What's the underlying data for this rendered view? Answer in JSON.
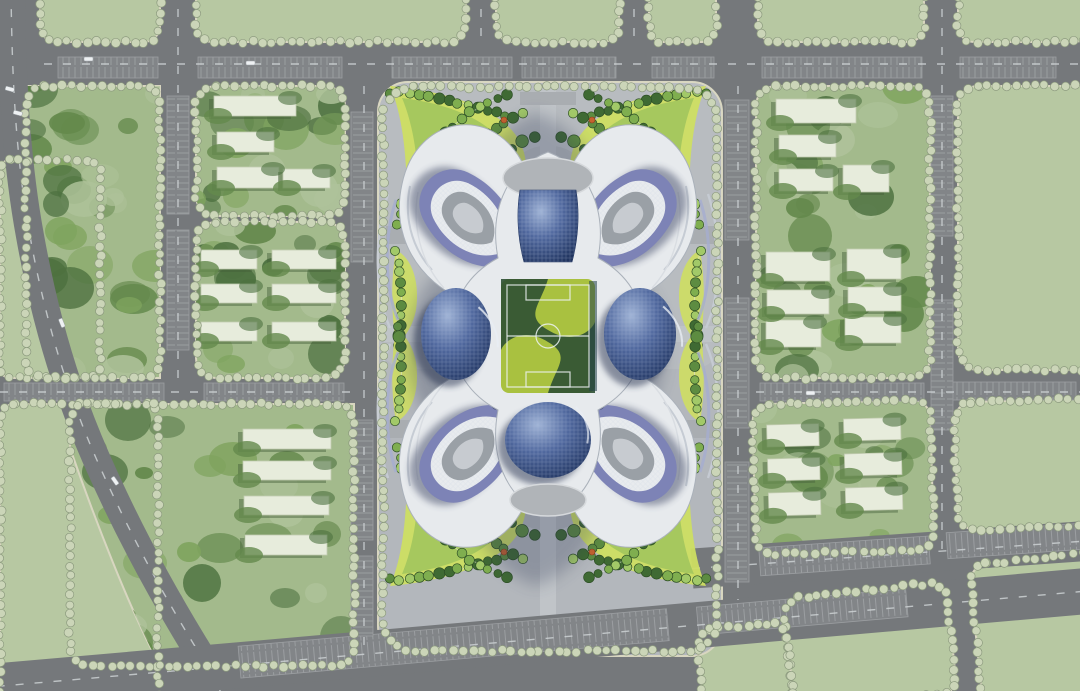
{
  "meta": {
    "kind": "architectural-master-plan-rendering",
    "visible_text": "none"
  },
  "palette": {
    "road": "#75787b",
    "hatch_fill": "#828588",
    "hatch_line": "#9b9ea1",
    "lane": "#cdd1d4",
    "field_green": "#b7c8a2",
    "block_green": "#a3ba8c",
    "curb": "#d8d6c0",
    "tree_mass_dark": "#4d7140",
    "tree_mass_mid": "#64894c",
    "tree_mass_light": "#7fa45e",
    "ground_light": "#aec29a",
    "street_tree": "#cbd5b8",
    "street_tree_rim": "#8c9a7e",
    "slab_white": "#e7ecdc",
    "slab_shadow": "#44603a",
    "plot_gray": "#b3b7bc",
    "plot_light": "#c0c4c8",
    "pad_gray": "#a9adb1",
    "building_white": "#e7eaed",
    "building_silver": "#c6ccd4",
    "ring_purple": "#7d83b6",
    "ring_purple_light": "#a5acd0",
    "ring_navy": "#323c64",
    "dome_light": "#9fb3d6",
    "dome_mid": "#51699f",
    "dome_dark": "#20345f",
    "court_gray": "#9aa0a6",
    "court_light": "#c7cbd0",
    "lawn_bright": "#a9c140",
    "lawn_dark": "#2d5033",
    "ribbon_yellow": "#cede62",
    "ribbon_green": "#9cc35c",
    "tree_a": "#3f6a33",
    "tree_b": "#5d8c41",
    "tree_c": "#7fae4f",
    "tree_d": "#a2c968",
    "shrub_orange": "#c4622f",
    "shadow_navy": "#2b3452",
    "car_white": "#eef1f3"
  },
  "map": {
    "canvas": {
      "w": 1080,
      "h": 691
    },
    "fields": [
      {
        "id": "f12a",
        "x": 0,
        "y": 160,
        "w": 100,
        "h": 218,
        "r": 10
      },
      {
        "id": "f12b",
        "x": 0,
        "y": 404,
        "w": 158,
        "h": 306,
        "r": 14
      },
      {
        "id": "f1",
        "x": 40,
        "y": -24,
        "w": 120,
        "h": 66,
        "r": 16
      },
      {
        "id": "f2",
        "x": 196,
        "y": -24,
        "w": 270,
        "h": 66,
        "r": 16
      },
      {
        "id": "f3",
        "x": 496,
        "y": -24,
        "w": 123,
        "h": 66,
        "r": 16
      },
      {
        "id": "f4",
        "x": 649,
        "y": -24,
        "w": 67,
        "h": 66,
        "r": 14
      },
      {
        "id": "f5",
        "x": 758,
        "y": -24,
        "w": 166,
        "h": 66,
        "r": 16
      },
      {
        "id": "f6",
        "x": 958,
        "y": -24,
        "w": 132,
        "h": 66,
        "r": 16
      },
      {
        "id": "f7",
        "x": 958,
        "y": 86,
        "w": 150,
        "h": 284,
        "r": 20
      },
      {
        "id": "f8",
        "x": 956,
        "y": 400,
        "w": 152,
        "h": 128,
        "r": 18,
        "rot": -2
      },
      {
        "id": "f9",
        "x": 976,
        "y": 558,
        "w": 140,
        "h": 150,
        "r": 18,
        "rot": -6
      },
      {
        "id": "f10",
        "x": 788,
        "y": 590,
        "w": 164,
        "h": 112,
        "r": 16,
        "rot": -6
      },
      {
        "id": "f11",
        "x": 700,
        "y": 626,
        "w": 90,
        "h": 84,
        "r": 14,
        "rot": -6
      }
    ],
    "tree_blocks": [
      {
        "id": "tb1",
        "poly": "M26,86 L160,86 L160,378 L62,378 L42,300 L30,206 L24,130 Z",
        "ring": [
          26,
          86,
          134,
          292,
          18
        ],
        "n": 34,
        "seed": 11
      },
      {
        "id": "b2",
        "rect": [
          196,
          86,
          149,
          130,
          20
        ],
        "n": 20,
        "seed": 22
      },
      {
        "id": "b3",
        "rect": [
          196,
          222,
          149,
          156,
          20
        ],
        "n": 22,
        "seed": 33
      },
      {
        "id": "b4",
        "rect": [
          756,
          86,
          174,
          292,
          20
        ],
        "n": 34,
        "seed": 44
      },
      {
        "id": "b5",
        "rect": [
          754,
          402,
          178,
          150,
          18
        ],
        "rot": [
          -1.5,
          843,
          477
        ],
        "n": 20,
        "seed": 55
      },
      {
        "id": "bl",
        "poly": "M70,404 L354,404 L354,666 L160,666 C130,610 95,520 70,448 Z",
        "ring": [
          70,
          404,
          284,
          262,
          18
        ],
        "n": 30,
        "seed": 66
      }
    ],
    "slabs": {
      "b2": [
        [
          214,
          96,
          82,
          20
        ],
        [
          217,
          132,
          57,
          20
        ],
        [
          217,
          167,
          62,
          21
        ],
        [
          283,
          169,
          47,
          19
        ]
      ],
      "b3": [
        [
          201,
          250,
          56,
          19
        ],
        [
          272,
          250,
          64,
          19
        ],
        [
          201,
          284,
          56,
          19
        ],
        [
          272,
          284,
          64,
          19
        ],
        [
          201,
          322,
          56,
          19
        ],
        [
          272,
          322,
          64,
          19
        ]
      ],
      "b4": [
        [
          776,
          99,
          80,
          24
        ],
        [
          779,
          135,
          57,
          22
        ],
        [
          779,
          169,
          54,
          22
        ],
        [
          843,
          165,
          46,
          27
        ],
        [
          766,
          252,
          64,
          29
        ],
        [
          847,
          249,
          54,
          30
        ],
        [
          767,
          290,
          62,
          24
        ],
        [
          848,
          287,
          53,
          24
        ],
        [
          766,
          320,
          55,
          27
        ],
        [
          845,
          317,
          56,
          26
        ]
      ],
      "b5": [
        [
          768,
          423,
          52,
          22
        ],
        [
          845,
          419,
          57,
          22
        ],
        [
          768,
          457,
          52,
          22
        ],
        [
          845,
          454,
          57,
          22
        ],
        [
          768,
          491,
          52,
          23
        ],
        [
          845,
          488,
          57,
          23
        ]
      ],
      "bl": [
        [
          243,
          429,
          88,
          20
        ],
        [
          243,
          461,
          88,
          19
        ],
        [
          244,
          496,
          85,
          19
        ],
        [
          245,
          535,
          82,
          20
        ]
      ]
    },
    "plot": {
      "x": 378,
      "y": 82,
      "w": 344,
      "h": 574,
      "r": 30,
      "walk_v": [
        540,
        88,
        16,
        556
      ],
      "walk_h": [
        384,
        326,
        332,
        16
      ],
      "circles": [
        [
          548,
          192,
          50
        ],
        [
          548,
          478,
          56
        ]
      ],
      "pads": [
        [
          684,
          226,
          30,
          18
        ],
        [
          684,
          420,
          30,
          18
        ],
        [
          386,
          226,
          30,
          18
        ],
        [
          386,
          420,
          30,
          18
        ],
        [
          520,
          92,
          56,
          13
        ],
        [
          520,
          638,
          56,
          11
        ]
      ]
    },
    "roads": {
      "diagonal": "M11,-10 C12,80 16,160 30,236 C44,314 66,390 96,458 C124,522 158,586 196,648 C208,668 216,680 224,700",
      "diagonal_width": 28,
      "bottom": {
        "rot": [
          -5,
          150,
          672
        ],
        "rect": [
          -80,
          650,
          1300,
          46
        ],
        "hatch": [
          [
            240,
            654,
            430,
            32
          ],
          [
            700,
            655,
            210,
            28
          ]
        ],
        "lane_y": 673
      },
      "right_low": {
        "rot": [
          -4,
          700,
          568
        ],
        "rect": [
          692,
          548,
          480,
          40
        ],
        "hatch": [
          [
            760,
            552,
            170,
            28
          ],
          [
            948,
            550,
            150,
            26
          ]
        ],
        "lane_y": 568
      },
      "hatches_h": [
        [
          58,
          57,
          100,
          21
        ],
        [
          198,
          57,
          144,
          21
        ],
        [
          392,
          57,
          120,
          21
        ],
        [
          522,
          57,
          94,
          21
        ],
        [
          652,
          57,
          62,
          21
        ],
        [
          762,
          57,
          160,
          21
        ],
        [
          960,
          57,
          96,
          21
        ],
        [
          4,
          383,
          160,
          18
        ],
        [
          204,
          383,
          140,
          18
        ],
        [
          760,
          383,
          164,
          18
        ],
        [
          936,
          382,
          140,
          18
        ]
      ],
      "hatches_v": [
        [
          167,
          96,
          22,
          118
        ],
        [
          167,
          230,
          22,
          120
        ],
        [
          351,
          112,
          22,
          150
        ],
        [
          351,
          420,
          22,
          120
        ],
        [
          351,
          556,
          22,
          80
        ],
        [
          725,
          100,
          24,
          140
        ],
        [
          725,
          298,
          24,
          130
        ],
        [
          725,
          462,
          24,
          120
        ],
        [
          931,
          96,
          22,
          140
        ],
        [
          931,
          300,
          22,
          130
        ]
      ],
      "lanes_h": [
        [
          44,
          64,
          1080,
          64
        ],
        [
          0,
          392,
          352,
          392
        ],
        [
          756,
          392,
          1080,
          392
        ]
      ],
      "lanes_v": [
        [
          178,
          -10,
          178,
          378
        ],
        [
          364,
          86,
          364,
          652
        ],
        [
          738,
          86,
          738,
          600
        ],
        [
          942,
          -10,
          942,
          556
        ],
        [
          481,
          -10,
          481,
          44
        ],
        [
          634,
          -10,
          634,
          44
        ]
      ]
    },
    "cars": [
      [
        246,
        61,
        0
      ],
      [
        84,
        57,
        0
      ],
      [
        6,
        86,
        15
      ],
      [
        14,
        110,
        15
      ],
      [
        62,
        318,
        68
      ],
      [
        114,
        476,
        55
      ],
      [
        806,
        391,
        0
      ]
    ],
    "ribbon": {
      "blob1": "M390,86 C455,92 505,112 520,142 C532,166 526,200 506,228 C488,252 458,264 434,258 C420,236 410,198 406,168 C404,132 398,104 390,86 Z",
      "blob2": "M402,98 C452,104 492,122 506,148 C516,170 510,198 494,220 C478,240 456,250 438,244 C428,222 420,192 417,166 C415,136 408,112 402,98 Z",
      "pocket": "M396,250 C412,258 420,282 416,310 C412,330 402,340 396,344 C392,320 390,284 396,250 Z",
      "arcs": [
        {
          "d": "M390,92 Q450,96 505,116",
          "n": 12
        },
        {
          "d": "M398,226 Q418,128 508,94",
          "n": 17
        },
        {
          "d": "M414,244 Q444,150 524,112",
          "n": 16
        },
        {
          "d": "M434,256 Q470,172 534,136",
          "n": 13
        },
        {
          "d": "M396,252 Q406,300 398,346",
          "n": 9
        }
      ],
      "oranges": [
        [
          444,
          206
        ],
        [
          468,
          178
        ],
        [
          496,
          148
        ],
        [
          430,
          238
        ],
        [
          416,
          200
        ],
        [
          504,
          120
        ],
        [
          478,
          226
        ]
      ]
    },
    "street_tree": {
      "spacing": 9.5,
      "radius": 4.2
    },
    "soccer_field": {
      "x": 501,
      "y": 279,
      "w": 94,
      "h": 114,
      "circle_r": 12,
      "penalty": [
        [
          526,
          285,
          44,
          15
        ],
        [
          526,
          372,
          44,
          15
        ]
      ]
    }
  }
}
